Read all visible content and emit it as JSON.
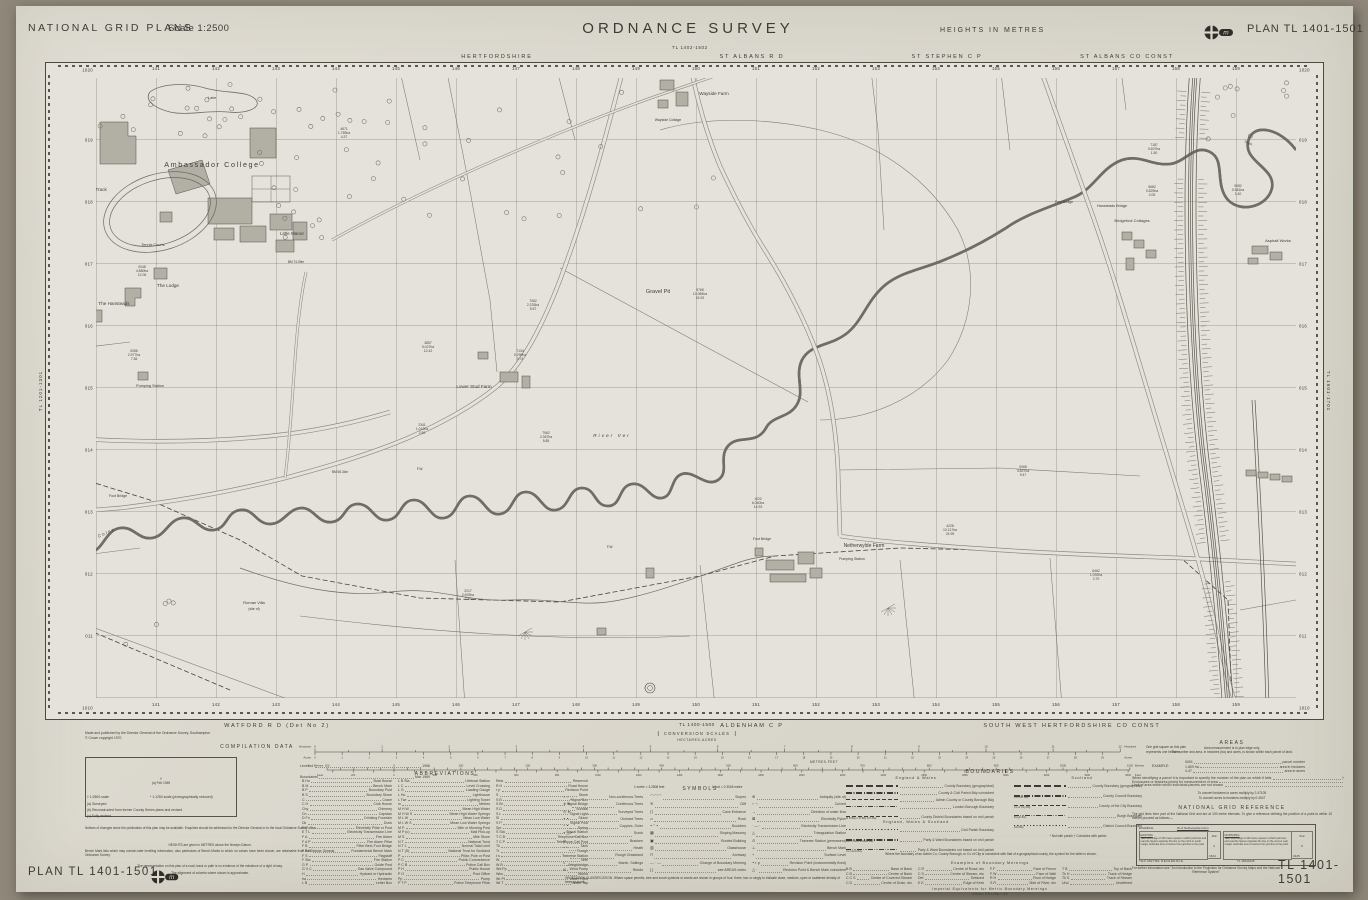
{
  "header": {
    "left_title": "NATIONAL GRID PLANS",
    "scale_label": "Scale 1:2500",
    "center_title": "ORDNANCE SURVEY",
    "heights_note": "HEIGHTS IN METRES",
    "plan_label": "PLAN TL 1401-1501",
    "sheet_ref_north": "TL 1402-1502"
  },
  "admin_top": [
    "HERTFORDSHIRE",
    "ST ALBANS R D",
    "ST STEPHEN C P",
    "ST ALBANS CO CONST"
  ],
  "admin_bottom": [
    "WATFORD R D (Det No 2)",
    "ALDENHAM C P",
    "SOUTH WEST HERTFORDSHIRE CO CONST"
  ],
  "map": {
    "eastings": [
      "141",
      "142",
      "143",
      "144",
      "145",
      "146",
      "147",
      "148",
      "149",
      "150",
      "151",
      "152",
      "153",
      "154",
      "155",
      "156",
      "157",
      "158",
      "159"
    ],
    "northings": [
      "019",
      "018",
      "017",
      "016",
      "015",
      "014",
      "013",
      "012",
      "011"
    ],
    "corner_top": "1020",
    "corner_bottom": "1010",
    "sheet_ref_west": "TL 1201-1301",
    "sheet_ref_east": "TL 1601-1701",
    "labels": [
      {
        "t": "Ambassador College",
        "x": 212,
        "y": 167,
        "s": 7.2,
        "ls": 1.6
      },
      {
        "t": "Running Track",
        "x": 92,
        "y": 191,
        "s": 4.6
      },
      {
        "t": "Lake",
        "x": 212,
        "y": 99,
        "s": 3.8,
        "i": 1
      },
      {
        "t": "Tennis Courts",
        "x": 153,
        "y": 246,
        "s": 3.8
      },
      {
        "t": "Little Manor",
        "x": 292,
        "y": 235,
        "s": 4.6
      },
      {
        "t": "The Lodge",
        "x": 168,
        "y": 287,
        "s": 4.6
      },
      {
        "t": "The Hansteads",
        "x": 114,
        "y": 305,
        "s": 4.6
      },
      {
        "t": "Pumping Station",
        "x": 150,
        "y": 387,
        "s": 3.8
      },
      {
        "t": "Wayside Farm",
        "x": 714,
        "y": 95,
        "s": 4.6
      },
      {
        "t": "Wayside Cottage",
        "x": 668,
        "y": 121,
        "s": 3.5
      },
      {
        "t": "Gravel Pit",
        "x": 658,
        "y": 293,
        "s": 5.5
      },
      {
        "t": "Lower Stud Farm",
        "x": 474,
        "y": 388,
        "s": 4.6
      },
      {
        "t": "River Ver",
        "x": 612,
        "y": 437,
        "s": 4.8,
        "ls": 2,
        "i": 1
      },
      {
        "t": "River Colne",
        "x": 98,
        "y": 538,
        "s": 4.4,
        "ls": 1.4,
        "i": 1,
        "r": -24
      },
      {
        "t": "Netherwylde Farm",
        "x": 864,
        "y": 547,
        "s": 5
      },
      {
        "t": "Pumping Station",
        "x": 852,
        "y": 560,
        "s": 3.5
      },
      {
        "t": "Foot Bridge",
        "x": 762,
        "y": 540,
        "s": 3.5
      },
      {
        "t": "Roman Villa",
        "x": 254,
        "y": 604,
        "s": 4
      },
      {
        "t": "(site of)",
        "x": 254,
        "y": 610,
        "s": 3.4
      },
      {
        "t": "Foot Bridge",
        "x": 1064,
        "y": 203,
        "s": 3.5
      },
      {
        "t": "Hansteads Bridge",
        "x": 1112,
        "y": 207,
        "s": 3.8
      },
      {
        "t": "Bridgefoot Cottages",
        "x": 1132,
        "y": 222,
        "s": 4
      },
      {
        "t": "Asphalt Works",
        "x": 1278,
        "y": 242,
        "s": 4
      },
      {
        "t": "Foot Bridge",
        "x": 118,
        "y": 497,
        "s": 3.5
      },
      {
        "t": "Drain",
        "x": 1248,
        "y": 144,
        "s": 3.4,
        "r": 25
      },
      {
        "t": "F.W.",
        "x": 610,
        "y": 548,
        "s": 3.2
      },
      {
        "t": "F.W.",
        "x": 420,
        "y": 470,
        "s": 3.2
      },
      {
        "t": "BM 65.34m",
        "x": 340,
        "y": 473,
        "s": 3.2
      },
      {
        "t": "BM 74.09m",
        "x": 296,
        "y": 263,
        "s": 3.2
      }
    ],
    "parcels": [
      [
        "0048",
        "4.880ha",
        "12.06",
        142,
        268
      ],
      [
        "0056",
        "2.977ha",
        "7.36",
        134,
        352
      ],
      [
        "4671",
        "1.769ha",
        "4.37",
        344,
        130
      ],
      [
        "3857",
        "5.027ha",
        "12.42",
        428,
        344
      ],
      [
        "7062",
        "2.233ha",
        "5.57",
        533,
        302
      ],
      [
        "7134",
        "0.299ha",
        "0.74",
        520,
        352
      ],
      [
        "9765",
        "10.089ha",
        "24.92",
        700,
        291
      ],
      [
        "7962",
        "2.367ha",
        "5.85",
        546,
        434
      ],
      [
        "2341",
        "1.012ha",
        "2.50",
        422,
        426
      ],
      [
        "0068",
        "3.827ha",
        "9.47",
        1023,
        468
      ],
      [
        "1022",
        "6.040ha",
        "14.93",
        758,
        500
      ],
      [
        "4228",
        "10.117ha",
        "24.99",
        950,
        527
      ],
      [
        "2217",
        "2.693ha",
        "7.40",
        468,
        592
      ],
      [
        "7187",
        "0.607ha",
        "1.50",
        1154,
        146
      ],
      [
        "5682",
        "0.829ha",
        "2.05",
        1152,
        188
      ],
      [
        "9082",
        "0.581ha",
        "1.40",
        1238,
        187
      ],
      [
        "6462",
        "1.092ha",
        "2.70",
        1096,
        572
      ]
    ]
  },
  "scales": {
    "sheet_ref_south": "TL 1400-1500",
    "title": "CONVERSION SCALES",
    "sub": "HECTARES-ACRES",
    "metres_feet": "METRES-FEET",
    "hectares_word": "Hectares",
    "acres_word": "Acres",
    "metres_word": "Metres",
    "feet_word": "Feet",
    "note1": "One grid square on this plan",
    "note2": "represents one hectare.",
    "m_to_ft": "1 metre = 3.2808 feet",
    "ft_to_m": "1 foot = 0.3048 metre",
    "hectares_max": 12,
    "acres_max": 29,
    "metres_max": 1100,
    "feet_max": 3600
  },
  "imprint1": "Made and published by the Director General of the Ordnance Survey, Southampton",
  "imprint2": "© Crown copyright 1970",
  "compilation": {
    "title": "COMPILATION DATA",
    "box_line1": "†",
    "box_line2": "(a) Feb 1969",
    "levelled_label": "Levelled",
    "levelled_value": "1956",
    "boundaries_label": "Boundaries",
    "boundaries_value": "Mar 1969",
    "fn1": "† 1:2500 scale",
    "fn2": "* 1:1250 scale (photographically reduced)",
    "fn3": "(a) Surveyed",
    "fn4": "(b) Reconstructed from former County Series plans and revised",
    "fn5": "(c) Fully revised",
    "note1": "Notices of changes since the publication of this plan may be available. Enquiries should be addressed to the Director General or to the local Ordnance Survey office.",
    "note2": "HEIGHTS are given in METRES above the Newlyn Datum.",
    "note3": "Bench Mark lists which may contain later levelling information, also particulars of Bench Marks to which no values have been shown, are obtainable from the Director General, Ordnance Survey.",
    "note4": "The representation on this plan of a road, track or path is no evidence of the existence of a right of way.",
    "note5": "The alignment of culverts where shown is approximate."
  },
  "abbreviations": {
    "title": "ABBREVIATIONS",
    "col1": [
      [
        "B Ho",
        "Boat House"
      ],
      [
        "B M",
        "Bench Mark"
      ],
      [
        "B P",
        "Boundary Post"
      ],
      [
        "B S",
        "Boundary Stone"
      ],
      [
        "C",
        "Crane"
      ],
      [
        "C H",
        "Club House"
      ],
      [
        "Chy",
        "Chimney"
      ],
      [
        "Cn",
        "Capstan"
      ],
      [
        "D Fn",
        "Drinking Fountain"
      ],
      [
        "Dk",
        "Dock"
      ],
      [
        "E P",
        "Electricity Pillar or Post"
      ],
      [
        "E T L",
        "Electricity Transmission Line"
      ],
      [
        "F A",
        "Fire Alarm"
      ],
      [
        "F A P",
        "Fire Alarm Pillar"
      ],
      [
        "F B",
        "Filter Bed; Foot Bridge"
      ],
      [
        "F B M",
        "Fundamental Bench Mark"
      ],
      [
        "F S",
        "Flagstaff"
      ],
      [
        "F Sta",
        "Fire Station"
      ],
      [
        "G P",
        "Guide Post"
      ],
      [
        "G V C",
        "Gas Valve Compound"
      ],
      [
        "H",
        "Hydrant or Hydraulic"
      ],
      [
        "ha",
        "Hectares"
      ],
      [
        "L B",
        "Letter Box"
      ]
    ],
    "col2": [
      [
        "L B Sta",
        "Lifeboat Station"
      ],
      [
        "L C",
        "Level Crossing"
      ],
      [
        "L G",
        "Loading Gauge"
      ],
      [
        "L Ho",
        "Lighthouse"
      ],
      [
        "L Twr",
        "Lighting Tower"
      ],
      [
        "m",
        "Metres"
      ],
      [
        "M H W",
        "Mean High Water"
      ],
      [
        "M H W S",
        "Mean High Water Springs"
      ],
      [
        "M L W",
        "Mean Low Water"
      ],
      [
        "M L W S",
        "Mean Low Water Springs"
      ],
      [
        "M P",
        "Mile or Mooring Post"
      ],
      [
        "M P (u)",
        "Mail Pick-up"
      ],
      [
        "M S",
        "Mile Stone"
      ],
      [
        "N T",
        "National Trust"
      ],
      [
        "N T L",
        "Normal Tidal Limit"
      ],
      [
        "N T (S)",
        "National Trust for Scotland"
      ],
      [
        "P",
        "Pillar, Pole or Post"
      ],
      [
        "P C",
        "Public Convenience"
      ],
      [
        "P C B",
        "Police Call Box"
      ],
      [
        "P H",
        "Public House"
      ],
      [
        "P O",
        "Post Office"
      ],
      [
        "Pp",
        "Pump"
      ],
      [
        "P T P",
        "Police Telephone Pillar"
      ]
    ],
    "col3": [
      [
        "Resr",
        "Reservoir"
      ],
      [
        "R H",
        "Road House"
      ],
      [
        "r p",
        "Revision Point"
      ],
      [
        "S",
        "Stone"
      ],
      [
        "S B",
        "Signal Box"
      ],
      [
        "S Br",
        "Signal Bridge"
      ],
      [
        "S D",
        "Sundial"
      ],
      [
        "S L",
        "Signal Light"
      ],
      [
        "Sl",
        "Sluice"
      ],
      [
        "S P",
        "Signal Post"
      ],
      [
        "Spr",
        "Spring"
      ],
      [
        "S Sta",
        "Signal Station"
      ],
      [
        "T C B",
        "Telephone Call Box"
      ],
      [
        "T C P",
        "Telephone Call Post"
      ],
      [
        "Tk",
        "Tank"
      ],
      [
        "Tr",
        "Trough"
      ],
      [
        "t s",
        "Traverse Station"
      ],
      [
        "W",
        "Well"
      ],
      [
        "W B",
        "Weighbridge"
      ],
      [
        "Wd Pp",
        "Wind Pump"
      ],
      [
        "Wks",
        "Works"
      ],
      [
        "Wr Pt",
        "Water Point"
      ],
      [
        "Wr T",
        "Water Tap"
      ]
    ]
  },
  "symbols": {
    "title": "SYMBOLS",
    "col1": [
      [
        "○ ○",
        "Non-coniferous Trees"
      ],
      [
        "∗ ∗",
        "Coniferous Trees"
      ],
      [
        "⊙ ∗",
        "Surveyed Trees"
      ],
      [
        "∘ ∘",
        "Orchard Trees"
      ],
      [
        "~ ∘",
        "Coppice, Osier"
      ],
      [
        "∘ △ ∘",
        "Scrub"
      ],
      [
        "ψ",
        "Bracken"
      ],
      [
        "^ ^",
        "Heath"
      ],
      [
        ", , ,",
        "Rough Grassland"
      ],
      [
        "≈",
        "Marsh, Saltings"
      ],
      [
        "Ψ",
        "Reeds"
      ]
    ],
    "col2": [
      [
        "⌒⌒⌒",
        "Slopes"
      ],
      [
        "≋",
        "Cliff"
      ],
      [
        "∏",
        "Cave Entrance"
      ],
      [
        "▱",
        "Rock"
      ],
      [
        "∘ ° ∘",
        "Boulders"
      ],
      [
        "▦",
        "Sloping Masonry"
      ],
      [
        "▣",
        "Roofed Building"
      ],
      [
        "▥",
        "Glasshouse"
      ],
      [
        "⊓",
        "Archway"
      ],
      [
        "— · —",
        "Change of Boundary Mereing"
      ],
      [
        "[  ]",
        "see AREAS notes"
      ]
    ],
    "col3": [
      [
        "⊕",
        "Antiquity (site of)"
      ],
      [
        "⌐ ¬",
        "Culvert"
      ],
      [
        "→",
        "Direction of water flow"
      ],
      [
        "⊠",
        "Electricity Pylon"
      ],
      [
        "· — ·",
        "Electricity Transmission Line"
      ],
      [
        "△",
        "Triangulation Station"
      ],
      [
        "⊙",
        "Traverse Station (permanent)"
      ],
      [
        "⊥",
        "Bench Mark"
      ],
      [
        "+",
        "Surface Level"
      ],
      [
        "∘ r p",
        "Revision Point (instrumentally fixed)"
      ],
      [
        "△ ·",
        "Revision Point & Bench Mark coincident"
      ]
    ],
    "veg_note": "VEGETATION CLASSIFICATION. Where space permits, tree and scrub symbols or words are shown in groups of four, three, two or singly to indicate close, medium, open or scattered density of trees or scrub."
  },
  "boundaries": {
    "title": "BOUNDARIES",
    "ew_title": "England & Wales",
    "scot_title": "Scotland",
    "ews_title": "England, Wales & Scotland",
    "ew_rows": [
      [
        0,
        "",
        "County Boundary (geographical)"
      ],
      [
        1,
        "",
        "County & Civil Parish Bdy coincident"
      ],
      [
        2,
        "",
        "Admin County or County Borough Bdy"
      ],
      [
        3,
        "",
        "London Borough Boundary"
      ],
      [
        2,
        "M B Bdy   U D Bdy   R D Bdy",
        "County District Boundaries based on civil parish"
      ]
    ],
    "ews_rows": [
      [
        4,
        "",
        "Civil Parish Boundary"
      ],
      [
        1,
        "Boro Const & Ward Bdy",
        "Parly & Ward Boundaries based on civil parish"
      ],
      [
        3,
        "Co Const Bdy",
        "Parly & Ward Boundaries not based on civil parish"
      ]
    ],
    "scot_rows": [
      [
        0,
        "",
        "County Boundary (geographical)"
      ],
      [
        1,
        "Co Cncl Bdy",
        "County Council Boundary"
      ],
      [
        2,
        "Co of City Bdy",
        "County of the City Boundary"
      ],
      [
        3,
        "Burgh Bdy",
        "Burgh Boundary"
      ],
      [
        4,
        "Dist Bdy",
        "District Council Boundary"
      ]
    ],
    "flags": "* Not with parish        † Coincides with parish",
    "note": "Where the boundary of an Admin Co, County Borough, or Co of City is coincident with that of a geographical county, the symbol for the latter is shown.",
    "mereings_title": "Examples of Boundary Mereings",
    "mereings": [
      [
        "B B",
        "Base of Bank"
      ],
      [
        "C B",
        "Centre of Bank"
      ],
      [
        "C C S",
        "Centre of Covered Stream"
      ],
      [
        "C D",
        "Centre of Drain, etc"
      ],
      [
        "C R",
        "Centre of Road, etc"
      ],
      [
        "C S",
        "Centre of Stream, etc"
      ],
      [
        "Def",
        "Defaced"
      ],
      [
        "E K",
        "Edge of Kerb"
      ],
      [
        "F F",
        "Face of Fence"
      ],
      [
        "F W",
        "Face of Wall"
      ],
      [
        "R H",
        "Root of Hedge"
      ],
      [
        "S R",
        "Side of River, etc"
      ],
      [
        "T B",
        "Top of Bank"
      ],
      [
        "Tk H",
        "Track of Hedge"
      ],
      [
        "Tk S",
        "Track of Stream"
      ],
      [
        "Und",
        "Undefined"
      ]
    ],
    "imperial_title": "Imperial Equivalents for Metric Boundary Mereings",
    "imperial_text": "0.91m = 3 ft          1.22m = 4 ft"
  },
  "areas": {
    "title": "AREAS",
    "line1": "Area measurement is to plan edge only.",
    "line2": "The number and area, in hectares (ha) and acres, is shown within each parcel of land.",
    "example_label": "EXAMPLE:",
    "example_rows": [
      [
        "0001",
        "parcel number"
      ],
      [
        "1.809 ha",
        "area in hectares"
      ],
      [
        "4.47",
        "area in acres"
      ]
    ],
    "notes": [
      [
        "When identifying a parcel it is important to specify the number of the plan on which it falls",
        "†"
      ],
      [
        "Enclosures or features joined for measurement of area",
        ""
      ],
      [
        "Limit of area within which individual parcels are not shown",
        ""
      ]
    ],
    "convert1": "To convert hectares to acres multiply by 2.47105",
    "convert2": "To convert acres to hectares multiply by 0.4047"
  },
  "ngr": {
    "title": "NATIONAL GRID REFERENCE",
    "intro": "The grid lines form part of the National Grid and are at 100 metre intervals. To give a reference defining the position of a point to within 10 metres proceed as follows:—",
    "example_label": "EXAMPLE:",
    "example_point": "W of Netherwylde Farm",
    "easting_title": "EASTING",
    "easting_text": "Take west edge of 100 metre square in which point lies and read the figures opposite this line on the north or south margin. Estimate tens of metres from grid line to the point.",
    "easting_v1": "152",
    "easting_v2": "4",
    "easting_v3": "1524",
    "northing_title": "NORTHING",
    "northing_text": "Take south edge of 100 metre square in which point lies and read the figures opposite this line on the west or east margin. Estimate tens of metres from grid line to the point.",
    "northing_v1": "012",
    "northing_v2": "5",
    "northing_v3": "0125",
    "ref_label": "TEN METRE REFERENCE",
    "ref_value": "TL 15240125",
    "footnote": "For further information see \"An Introduction to the Projection for Ordnance Survey Maps and the National Reference System\""
  },
  "footer": {
    "plan_left": "PLAN TL 1401-1501",
    "plan_right": "TL 1401-1501"
  }
}
